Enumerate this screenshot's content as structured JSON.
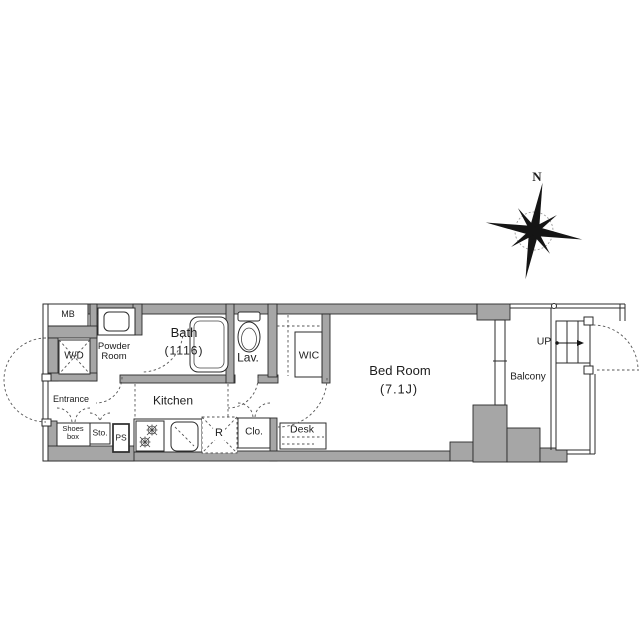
{
  "compass": {
    "north": "N"
  },
  "rooms": {
    "mb": "MB",
    "wd": "W/D",
    "powder_line1": "Powder",
    "powder_line2": "Room",
    "bath": "Bath",
    "bath_size": "(1116)",
    "lav": "Lav.",
    "wic": "WIC",
    "bedroom": "Bed Room",
    "bedroom_size": "(7.1J)",
    "balcony": "Balcony",
    "up": "UP",
    "entrance": "Entrance",
    "kitchen": "Kitchen",
    "shoes_line1": "Shoes",
    "shoes_line2": "box",
    "sto": "Sto.",
    "ps": "PS",
    "fridge": "R",
    "clo": "Clo.",
    "desk": "Desk"
  },
  "colors": {
    "wall": "#a6a6a6",
    "line": "#2b2b2b",
    "dash": "#555555"
  }
}
